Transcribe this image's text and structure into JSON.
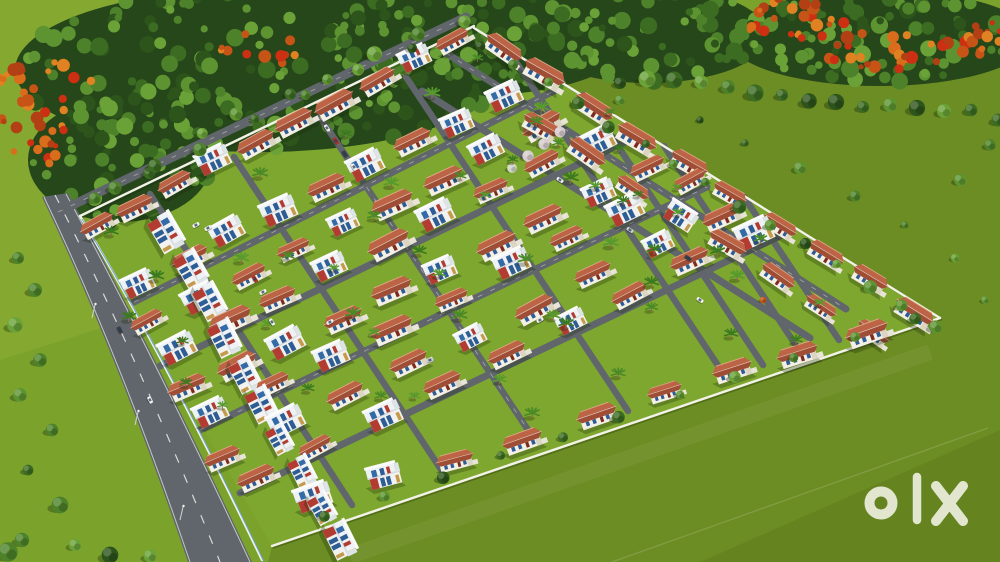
{
  "watermark": {
    "text": "olx",
    "color": "#eceedd",
    "position": "bottom-right"
  },
  "palette": {
    "grass": "#7ba32c",
    "meadow_light": "#97b53c",
    "estate_lawn": "#7ea72f",
    "field": "#6c8d23",
    "forest_base": "#26471a",
    "forest_greens": [
      "#2d541b",
      "#3c6b22",
      "#4d822a",
      "#5d9431",
      "#6aa238"
    ],
    "flame_colors": [
      "#c75417",
      "#d96d1c",
      "#b33f14",
      "#e08222",
      "#cc2f12"
    ],
    "blossom_colors": [
      "#d8cccf",
      "#cfd6c4"
    ],
    "road": "#60666b",
    "road_marking": "#eeeeea",
    "wall": "#f3f2e8",
    "roof_terracotta": "#a04d36",
    "roof_light": "#bd6346",
    "villa_wall": "#f3efe4",
    "glass_blue": "#2e5c95",
    "accent_red": "#b23c31",
    "accent_wood": "#c69a4c",
    "palm_greens": [
      "#3c7a1f",
      "#4a8a26",
      "#579a2d"
    ],
    "tree_shadow": "rgba(25,40,8,0.35)",
    "car_colors": {
      "w": "#f2f2f0",
      "s": "#c9cdd1",
      "r": "#b03028",
      "k": "#3a3f46"
    }
  }
}
